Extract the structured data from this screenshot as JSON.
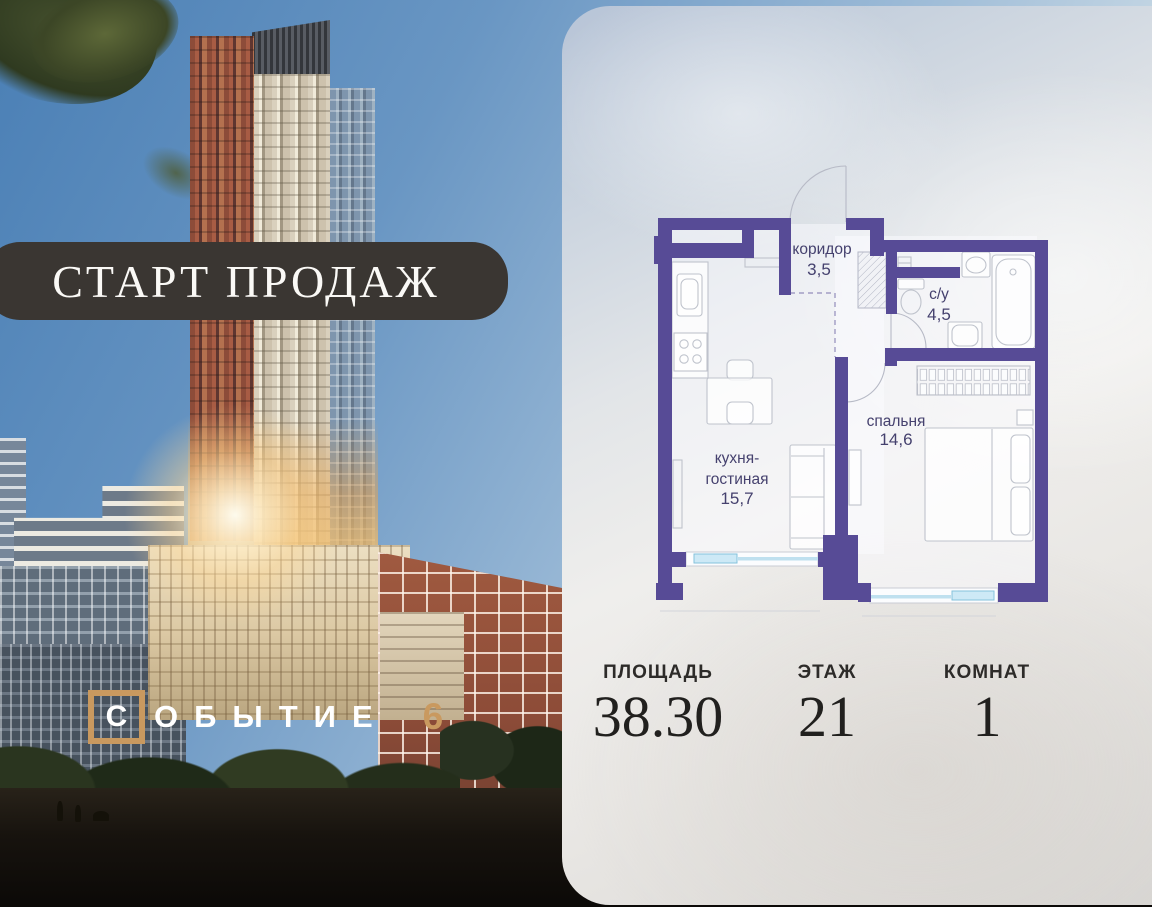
{
  "promo": {
    "banner_text": "СТАРТ ПРОДАЖ"
  },
  "logo": {
    "first_letter": "С",
    "rest": "ОБЫТИЕ",
    "number": "6"
  },
  "floorplan": {
    "corridor": {
      "name": "коридор",
      "area": "3,5"
    },
    "bathroom": {
      "name": "с/у",
      "area": "4,5"
    },
    "kitchen_living": {
      "name_line1": "кухня-",
      "name_line2": "гостиная",
      "area": "15,7"
    },
    "bedroom": {
      "name": "спальня",
      "area": "14,6"
    }
  },
  "stats": [
    {
      "label": "ПЛОЩАДЬ",
      "value": "38.30"
    },
    {
      "label": "ЭТАЖ",
      "value": "21"
    },
    {
      "label": "КОМНАТ",
      "value": "1"
    }
  ],
  "colors": {
    "wall": "#574b96",
    "room_label": "#45416e",
    "window_glass": "#cde9f6",
    "accent_tan": "#c9995f",
    "banner_bg": "#3a3632"
  }
}
